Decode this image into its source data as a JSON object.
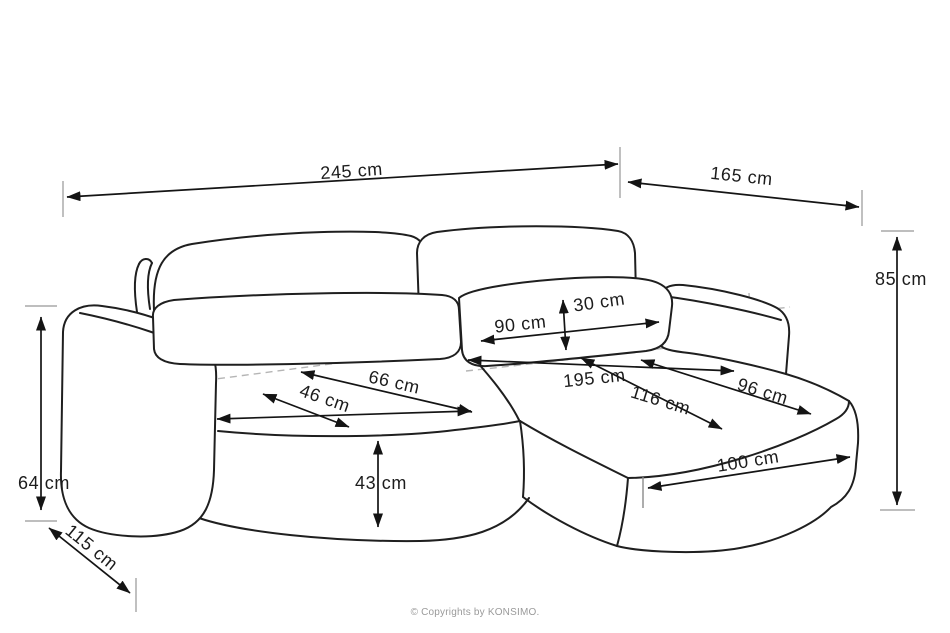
{
  "page": {
    "background": "#ffffff"
  },
  "diagram": {
    "type": "furniture-dimension-drawing",
    "subject": "corner sofa with chaise and sleeping function",
    "line_color": "#1f1f1f",
    "dimension_color": "#141414",
    "tick_color": "#b5b5b5",
    "dimensions": [
      {
        "id": "total-width",
        "label": "245 cm"
      },
      {
        "id": "chaise-depth",
        "label": "165 cm"
      },
      {
        "id": "total-height",
        "label": "85 cm"
      },
      {
        "id": "back-cushion-width",
        "label": "90 cm"
      },
      {
        "id": "back-cushion-height",
        "label": "30 cm"
      },
      {
        "id": "sleeping-length",
        "label": "195 cm"
      },
      {
        "id": "seat-depth",
        "label": "66 cm"
      },
      {
        "id": "seat-cushion-depth",
        "label": "46 cm"
      },
      {
        "id": "sleeping-width",
        "label": "116 cm"
      },
      {
        "id": "chaise-cushion-width",
        "label": "96 cm"
      },
      {
        "id": "seat-height",
        "label": "43 cm"
      },
      {
        "id": "chaise-seat-length",
        "label": "100 cm"
      },
      {
        "id": "armrest-height",
        "label": "64 cm"
      },
      {
        "id": "total-depth",
        "label": "115 cm"
      }
    ]
  },
  "footer": {
    "copyright": "© Copyrights by KONSIMO."
  }
}
